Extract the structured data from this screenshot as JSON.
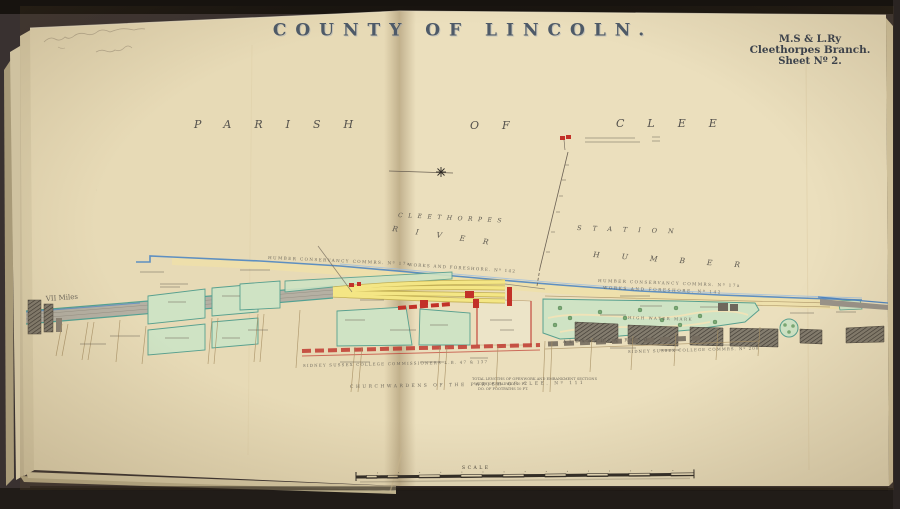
{
  "title": "COUNTY OF LINCOLN.",
  "corner": {
    "line1": "M.S & L.Ry",
    "line2": "Cleethorpes Branch.",
    "line3": "Sheet Nº 2."
  },
  "pencil_note": "illegible pencil inscription, two lines",
  "parish": {
    "word1": "PARISH",
    "word2": "OF",
    "word3": "CLEE"
  },
  "labels": {
    "miles": "VII Miles",
    "cleethorpes": "CLEETHORPES",
    "station": "STATION",
    "river": "RIVER",
    "humber": "HUMBER",
    "conservancy": "HUMBER CONSERVANCY COMMRS. Nº 17a",
    "foreshore": "WORKS AND FORESHORE. Nº 142",
    "high_water": "HIGH WATER MARK",
    "alexandra": "ALEXANDRA ROAD",
    "college_left": "SIDNEY SUSSEX COLLEGE COMMISSIONERS L.B. 47 & 137",
    "college_right": "SIDNEY SUSSEX COLLEGE COMMRS. Nº 200",
    "churchwardens": "CHURCHWARDENS OF THE PARISH OF CLEE. Nº 111",
    "note1": "TOTAL LENGTHS OF OPENWORK AND EMBANKMENT SECTIONS",
    "note2": "WIDTH OF ROADWAY 40 FT.",
    "note3": "DO. OF FOOTPATHS 10 FT.",
    "scale": "SCALE"
  },
  "colors": {
    "background": "#393130",
    "paper_left": "#e7dab6",
    "paper_right": "#ebdfbd",
    "page_edge": "#d3c6a4",
    "title_ink": "#4e5a68",
    "body_ink": "#39414e",
    "map_ink": "#5a564e",
    "pencil_grey": "#9b8e78",
    "parcel_green": "#cfe3c4",
    "parcel_outline": "#58a08f",
    "tree_green": "#7aa873",
    "siding_yellow": "#f4e685",
    "building_red": "#c23128",
    "road_buff": "#eedfab",
    "water_blue": "#4f86c2",
    "rail_grey": "#b5b0a3",
    "hatch_dark": "#4a443a"
  }
}
